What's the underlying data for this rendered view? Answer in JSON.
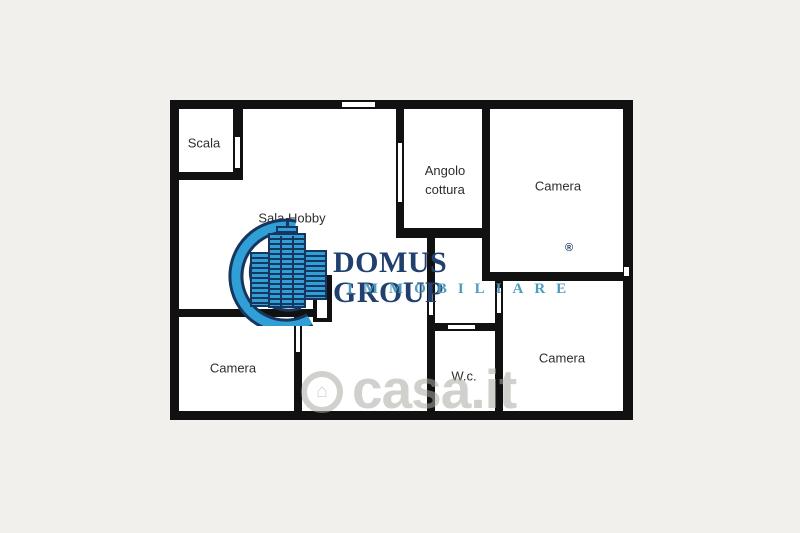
{
  "page": {
    "background": "#f2f0ed"
  },
  "floorplan": {
    "wall_color": "#111111",
    "floor_color": "#ffffff",
    "area": {
      "x": 170,
      "y": 100,
      "w": 463,
      "h": 320
    },
    "walls": [
      {
        "name": "outer-top",
        "x": 170,
        "y": 100,
        "w": 463,
        "h": 9
      },
      {
        "name": "outer-left",
        "x": 170,
        "y": 100,
        "w": 9,
        "h": 320
      },
      {
        "name": "outer-bottom",
        "x": 170,
        "y": 411,
        "w": 463,
        "h": 9
      },
      {
        "name": "outer-right",
        "x": 623,
        "y": 100,
        "w": 10,
        "h": 320
      },
      {
        "name": "scala-right",
        "x": 233,
        "y": 100,
        "w": 10,
        "h": 80
      },
      {
        "name": "scala-bottom",
        "x": 170,
        "y": 172,
        "w": 73,
        "h": 8
      },
      {
        "name": "cottura-left",
        "x": 396,
        "y": 100,
        "w": 8,
        "h": 136
      },
      {
        "name": "cottura-bottom",
        "x": 396,
        "y": 228,
        "w": 94,
        "h": 10
      },
      {
        "name": "cottura-right",
        "x": 482,
        "y": 100,
        "w": 8,
        "h": 181
      },
      {
        "name": "mid-right",
        "x": 482,
        "y": 272,
        "w": 151,
        "h": 9
      },
      {
        "name": "corridor-right",
        "x": 495,
        "y": 281,
        "w": 8,
        "h": 139
      },
      {
        "name": "wc-left",
        "x": 427,
        "y": 236,
        "w": 8,
        "h": 184
      },
      {
        "name": "wc-top",
        "x": 427,
        "y": 323,
        "w": 76,
        "h": 8
      },
      {
        "name": "mid-left",
        "x": 170,
        "y": 309,
        "w": 148,
        "h": 8
      },
      {
        "name": "camera-bl-right",
        "x": 294,
        "y": 317,
        "w": 8,
        "h": 103
      },
      {
        "name": "hall-door-frame",
        "x": 313,
        "y": 275,
        "w": 19,
        "h": 47
      }
    ],
    "openings": [
      {
        "name": "window-top",
        "x": 342,
        "y": 101,
        "w": 33,
        "h": 7,
        "edges": "h"
      },
      {
        "name": "door-scala",
        "x": 234,
        "y": 137,
        "w": 7,
        "h": 31,
        "edges": "v"
      },
      {
        "name": "window-cottura",
        "x": 397,
        "y": 143,
        "w": 6,
        "h": 59,
        "edges": "v"
      },
      {
        "name": "door-corridor",
        "x": 496,
        "y": 288,
        "w": 6,
        "h": 25,
        "edges": "v"
      },
      {
        "name": "door-wc",
        "x": 428,
        "y": 293,
        "w": 6,
        "h": 22,
        "edges": "v"
      },
      {
        "name": "window-wc",
        "x": 448,
        "y": 324,
        "w": 27,
        "h": 6,
        "edges": "h"
      },
      {
        "name": "door-camera-bl",
        "x": 295,
        "y": 323,
        "w": 6,
        "h": 29,
        "edges": "v"
      },
      {
        "name": "door-hall",
        "x": 317,
        "y": 280,
        "w": 10,
        "h": 38,
        "edges": "none"
      },
      {
        "name": "notch-right",
        "x": 624,
        "y": 267,
        "w": 5,
        "h": 9,
        "edges": "none"
      }
    ],
    "rooms": [
      {
        "label": "Scala",
        "x": 204,
        "y": 144
      },
      {
        "label": "Sala Hobby",
        "x": 292,
        "y": 219
      },
      {
        "label": "Angolo cottura",
        "x": 445,
        "y": 181,
        "maxw": 64
      },
      {
        "label": "Camera",
        "x": 558,
        "y": 187
      },
      {
        "label": "Camera",
        "x": 233,
        "y": 369
      },
      {
        "label": "W.c.",
        "x": 464,
        "y": 377
      },
      {
        "label": "Camera",
        "x": 562,
        "y": 359
      }
    ]
  },
  "logo": {
    "title": "DOMUS GROUP",
    "registered": "®",
    "subtitle": "IMMOBILIARE",
    "title_color": "#21406f",
    "subtitle_color": "#4d9cbe",
    "icon_blue": "#2f9fd6",
    "icon_navy": "#17365f"
  },
  "watermark": {
    "text": "casa.it",
    "house_glyph": "⌂"
  }
}
